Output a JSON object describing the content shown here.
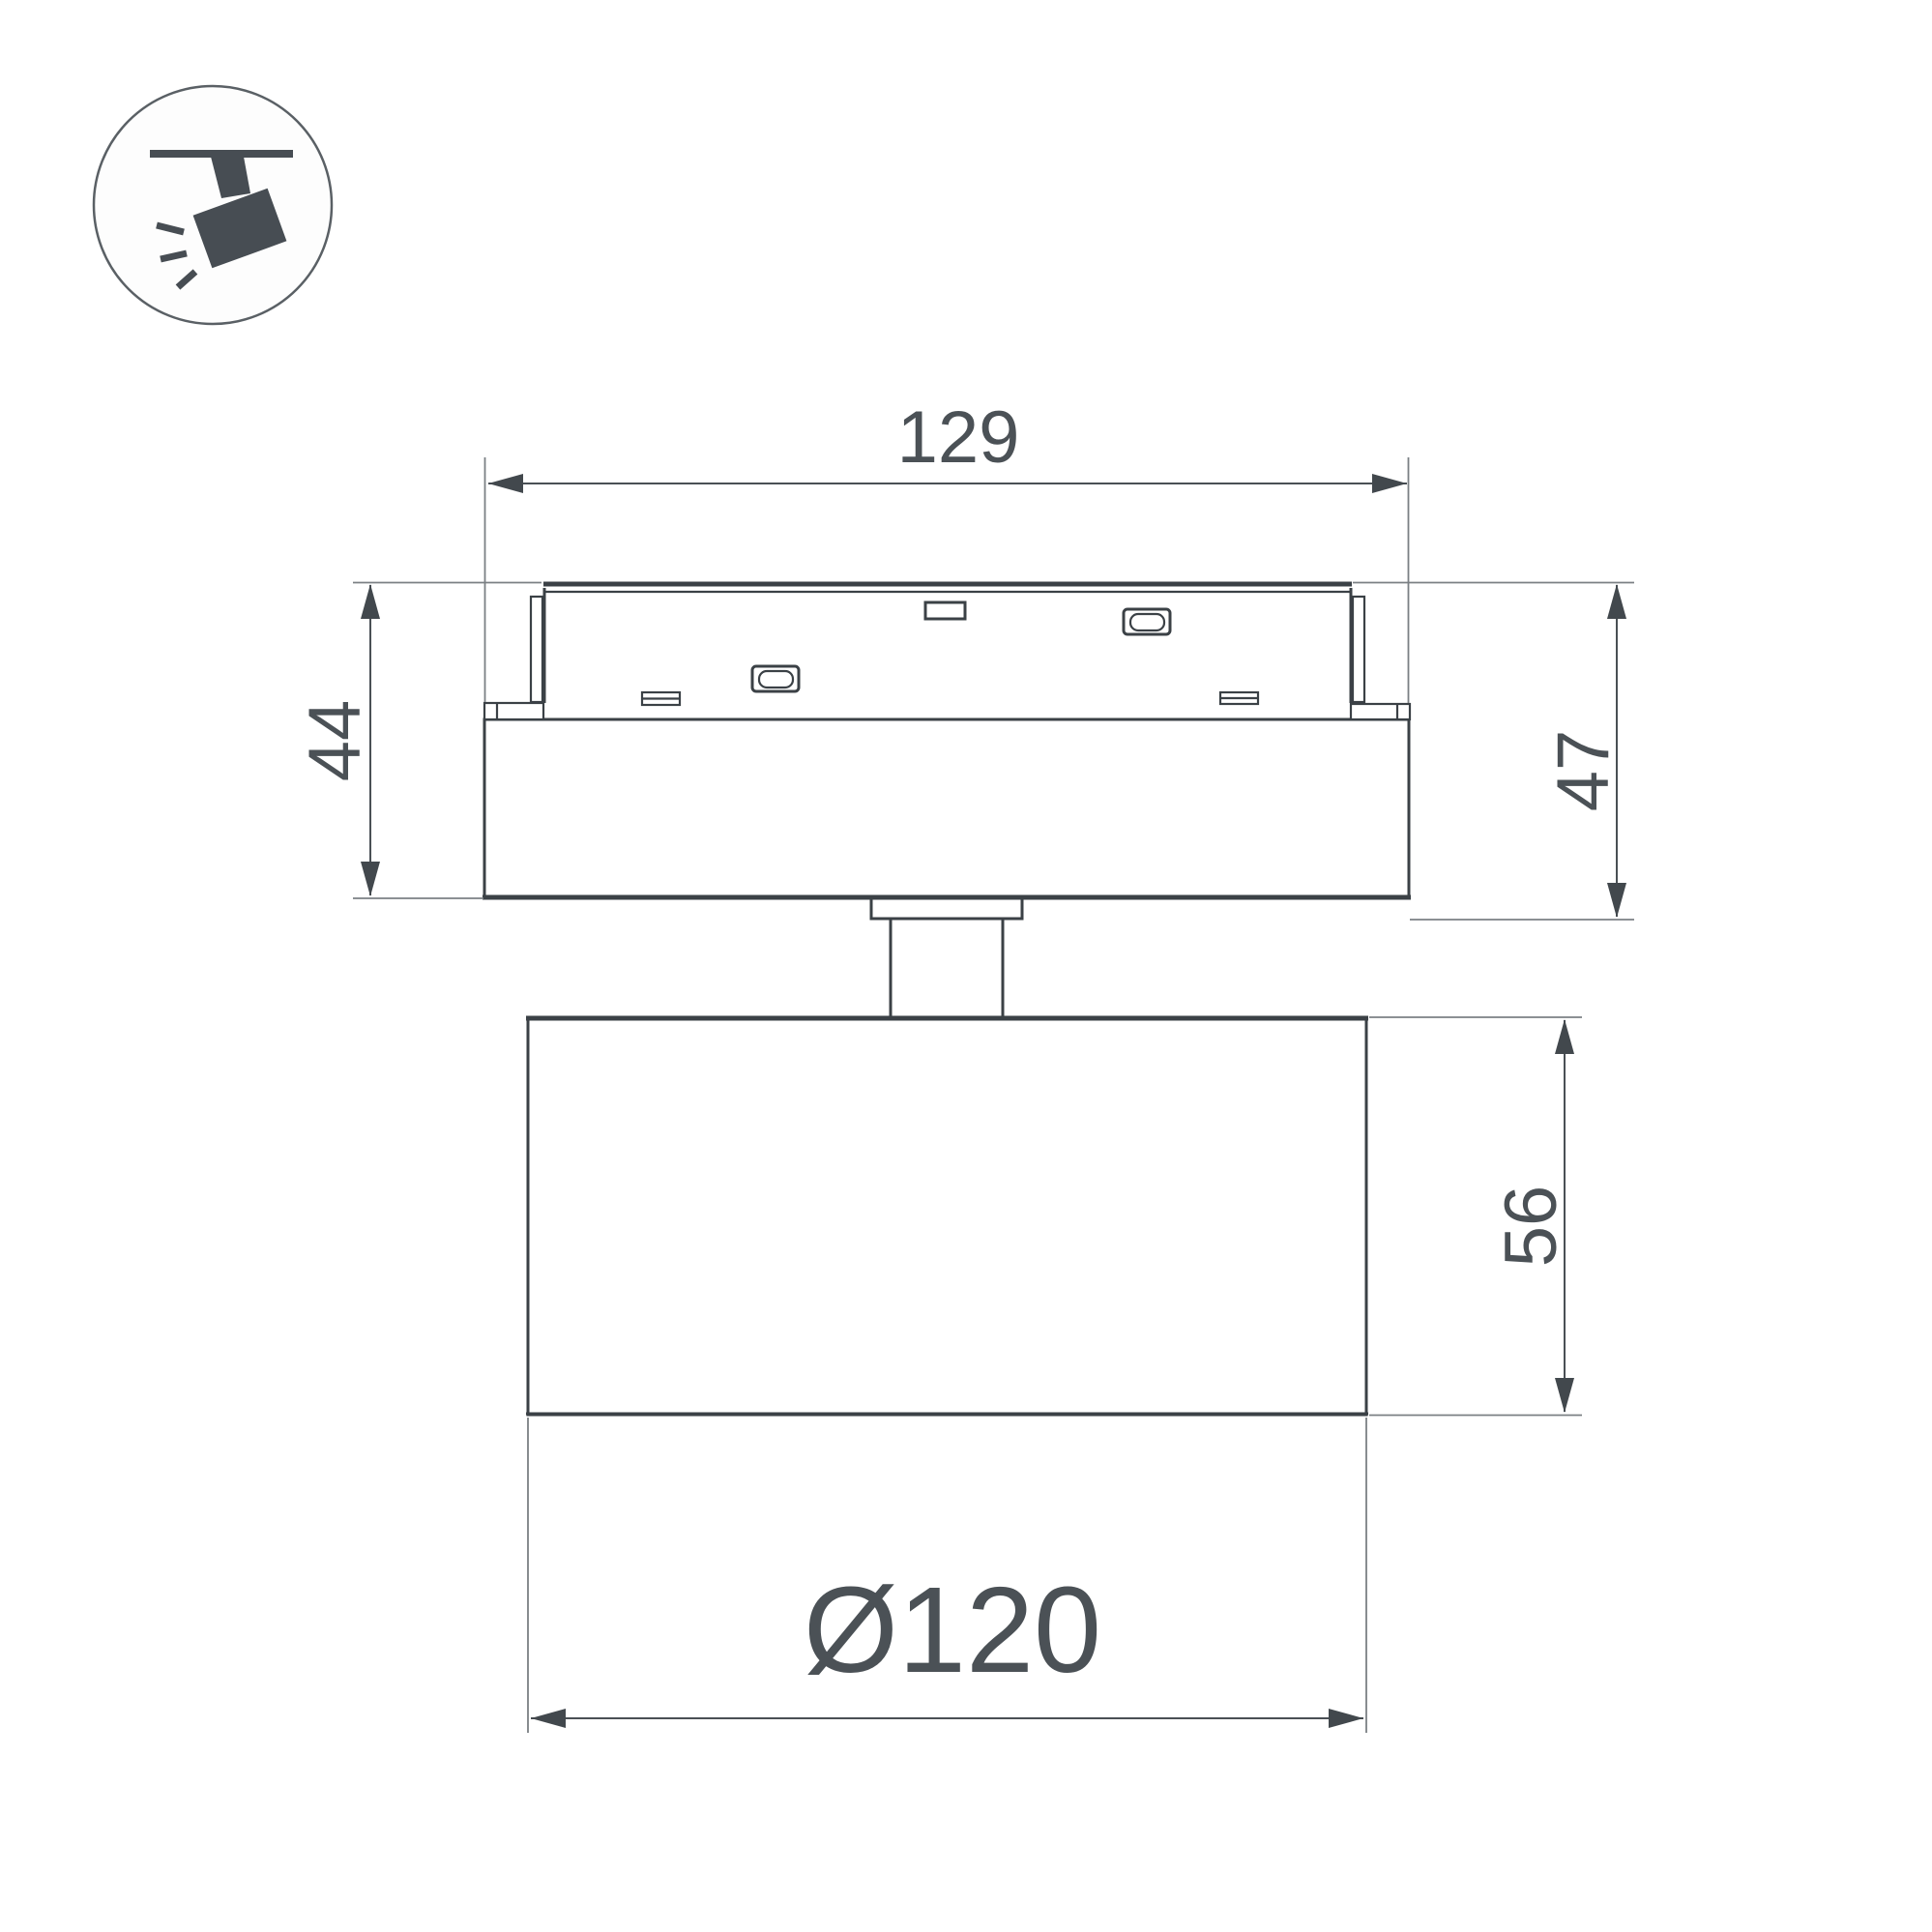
{
  "icon": {
    "name": "track-spotlight-icon"
  },
  "drawing": {
    "title": "track spotlight dimension drawing",
    "dimensions": {
      "base_length": "129",
      "height_left": "44",
      "height_right": "47",
      "head_height": "56",
      "head_diameter": "Ø120"
    },
    "colors": {
      "outline": "#3b4146",
      "dimension_line": "#4a5055",
      "extension_line": "#7b8084",
      "text": "#4b5156"
    }
  }
}
